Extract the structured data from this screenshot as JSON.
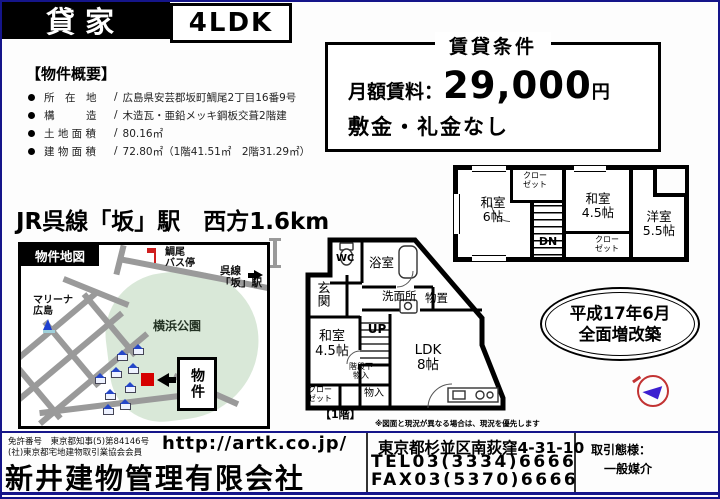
{
  "header": {
    "property_type": "貸家",
    "layout": "4LDK"
  },
  "overview": {
    "title": "【物件概要】",
    "rows": [
      {
        "label": "所　在　地",
        "sep": "/",
        "value": "広島県安芸郡坂町鯛尾2丁目16番9号"
      },
      {
        "label": "構　　　造",
        "sep": "/",
        "value": "木造瓦・亜鉛メッキ鋼板交葺2階建"
      },
      {
        "label": "土 地 面 積",
        "sep": "/",
        "value": "80.16㎡"
      },
      {
        "label": "建 物 面 積",
        "sep": "/",
        "value": "72.80㎡（1階41.51㎡　2階31.29㎡）"
      }
    ]
  },
  "rent_box": {
    "title": "賃貸条件",
    "rent_label": "月額賃料：",
    "rent_amount": "29,000",
    "rent_unit": "円",
    "deposit_note": "敷金・礼金なし"
  },
  "access": {
    "line": "JR呉線「坂」駅　西方1.6km"
  },
  "map": {
    "title": "物件地図",
    "bus_stop_l1": "鯛尾",
    "bus_stop_l2": "バス停",
    "station_l1": "呉線",
    "station_l2": "「坂」駅",
    "park": "横浜公園",
    "marina_l1": "マリーナ",
    "marina_l2": "広島",
    "property_label": "物件"
  },
  "floor2": {
    "room1_l1": "和室",
    "room1_l2": "6帖",
    "closet_top_l1": "クロー",
    "closet_top_l2": "ゼット",
    "stairs_label": "DN",
    "room2_l1": "和室",
    "room2_l2": "4.5帖",
    "closet_bottom_l1": "クロー",
    "closet_bottom_l2": "ゼット",
    "room3_l1": "洋室",
    "room3_l2": "5.5帖"
  },
  "floor1": {
    "wc": "WC",
    "bath": "浴室",
    "entrance": "玄関",
    "washroom": "洗面所",
    "storage": "物置",
    "washitsu_l1": "和室",
    "washitsu_l2": "4.5帖",
    "stairs_label": "UP",
    "ldk_l1": "LDK",
    "ldk_l2": "8帖",
    "understair_l1": "階段下",
    "understair_l2": "物入",
    "closet_l1": "クロー",
    "closet_l2": "ゼット",
    "monoire": "物入",
    "floor_label": "【1階】",
    "note": "※図面と現況が異なる場合は、現況を優先します"
  },
  "renovation": {
    "line1": "平成17年6月",
    "line2": "全面増改築"
  },
  "footer": {
    "license1": "免許番号　東京都知事(5)第84146号",
    "license2": "(社)東京都宅地建物取引業協会会員",
    "url": "http://artk.co.jp/",
    "company": "新井建物管理有限会社",
    "address": "東京都杉並区南荻窪4-31-10",
    "tel": "TEL03(3334)6666",
    "fax": "FAX03(5370)6666",
    "deal_type_label": "取引態様：",
    "deal_type_value": "一般媒介"
  },
  "icons": {
    "bus_stop": "bus-stop-flag-icon",
    "marina": "sailboat-icon",
    "compass": "north-arrow-icon",
    "property_marker": "red-square-marker",
    "station_arrow": "right-arrow-icon"
  },
  "colors": {
    "border_navy": "#15158a",
    "road_gray": "#9a9a9a",
    "park_green": "#d9e8d8",
    "marker_red": "#d60000",
    "compass_blue": "#3c1fd0"
  }
}
